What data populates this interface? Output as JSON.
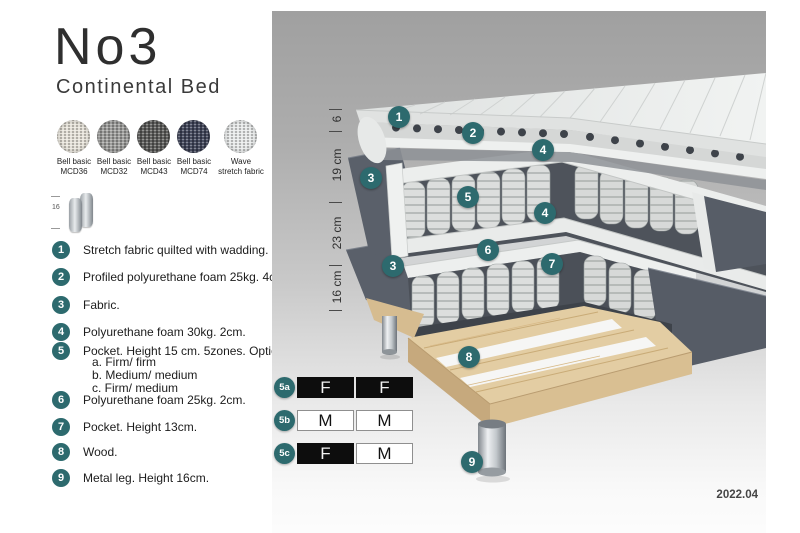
{
  "page": {
    "title": "No3",
    "subtitle": "Continental Bed",
    "edition": "2022.04"
  },
  "colors": {
    "badge_teal": "#2d6a6e",
    "panel_gray_top": "#a0a0a0",
    "table_black": "#0d0d0d",
    "fabric_dark": "#5a606a",
    "wood": "#e3cda3"
  },
  "swatches": [
    {
      "line1": "Bell basic",
      "line2": "MCD36",
      "color": "#e8e4da"
    },
    {
      "line1": "Bell basic",
      "line2": "MCD32",
      "color": "#9c9c9a"
    },
    {
      "line1": "Bell basic",
      "line2": "MCD43",
      "color": "#585856"
    },
    {
      "line1": "Bell basic",
      "line2": "MCD74",
      "color": "#3c4156"
    },
    {
      "line1": "Wave",
      "line2": "stretch fabric",
      "color": "#e9ebeb"
    }
  ],
  "leg_icon": {
    "height_label": "16"
  },
  "legend": {
    "items": [
      {
        "number": "1",
        "text": "Stretch fabric quilted with wadding."
      },
      {
        "number": "2",
        "text": "Profiled polyurethane foam 25kg. 4cm."
      },
      {
        "number": "3",
        "text": "Fabric."
      },
      {
        "number": "4",
        "text": "Polyurethane foam 30kg. 2cm."
      },
      {
        "number": "5",
        "text": "Pocket. Height 15 cm. 5zones. Option:"
      },
      {
        "number": "6",
        "text": "Polyurethane foam 25kg. 2cm."
      },
      {
        "number": "7",
        "text": "Pocket. Height 13cm."
      },
      {
        "number": "8",
        "text": "Wood."
      },
      {
        "number": "9",
        "text": "Metal leg. Height 16cm."
      }
    ],
    "item5_options": [
      "a. Firm/ firm",
      "b. Medium/ medium",
      "c. Firm/ medium"
    ]
  },
  "diagram": {
    "ruler": [
      {
        "label": "6"
      },
      {
        "label": "19 cm"
      },
      {
        "label": "23 cm"
      },
      {
        "label": "16 cm"
      }
    ],
    "callouts": [
      "1",
      "2",
      "4",
      "3",
      "5",
      "4",
      "6",
      "3",
      "7",
      "8",
      "9"
    ]
  },
  "firmness": {
    "rows": [
      {
        "id": "5a",
        "cells": [
          {
            "value": "F",
            "style": "dark"
          },
          {
            "value": "F",
            "style": "dark"
          }
        ]
      },
      {
        "id": "5b",
        "cells": [
          {
            "value": "M",
            "style": "light"
          },
          {
            "value": "M",
            "style": "light"
          }
        ]
      },
      {
        "id": "5c",
        "cells": [
          {
            "value": "F",
            "style": "dark"
          },
          {
            "value": "M",
            "style": "light"
          }
        ]
      }
    ]
  }
}
